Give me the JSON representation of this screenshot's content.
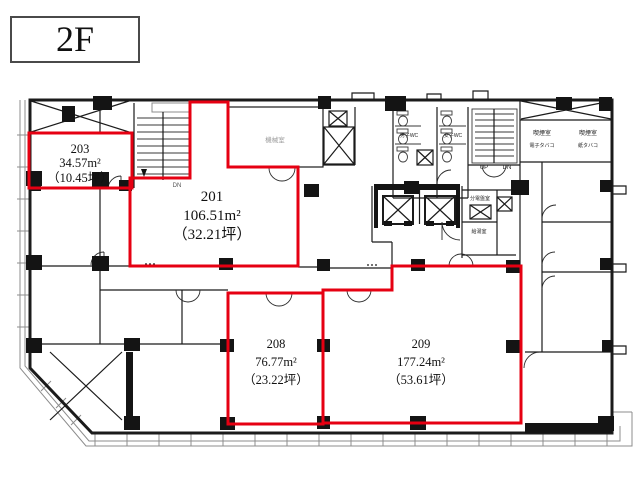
{
  "title": {
    "floor": "2F"
  },
  "colors": {
    "highlight": "#e60012",
    "wall": "#1b1b1b"
  },
  "rooms": [
    {
      "number": "203",
      "area": "34.57m²",
      "tsubo": "（10.45坪）"
    },
    {
      "number": "201",
      "area": "106.51m²",
      "tsubo": "（32.21坪）"
    },
    {
      "number": "208",
      "area": "76.77m²",
      "tsubo": "（23.22坪）"
    },
    {
      "number": "209",
      "area": "177.24m²",
      "tsubo": "（53.61坪）"
    }
  ],
  "labels": {
    "mens_wc": "男子WC",
    "womens_wc": "女子WC",
    "smoking1_l1": "喫煙室",
    "smoking1_l2": "電子タバコ",
    "smoking2_l1": "喫煙室",
    "smoking2_l2": "紙タバコ",
    "panel_room": "分電盤室",
    "kitchenette": "給湯室",
    "machine_room": "機械室",
    "up": "UP",
    "dn": "DN",
    "dn_left": "DN"
  }
}
